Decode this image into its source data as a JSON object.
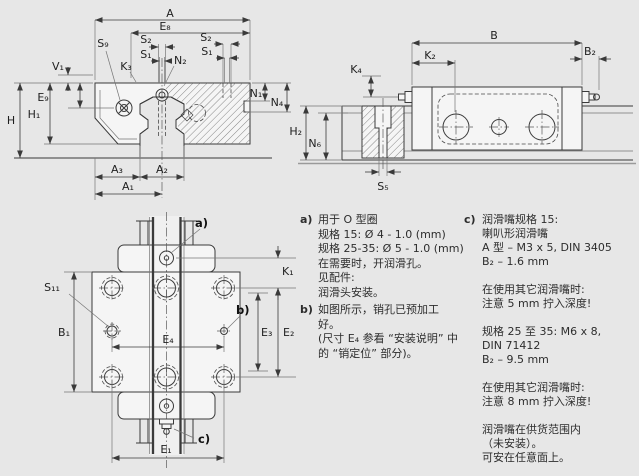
{
  "colors": {
    "background": "#e7e7e7",
    "ink": "#3a3a3a",
    "shape_fill": "#f5f5f5",
    "gray_line": "#9a9a9a"
  },
  "views": {
    "front": {
      "dims": {
        "A": "A",
        "E8": "E₈",
        "S2": "S₂",
        "S1": "S₁",
        "N2": "N₂",
        "S9": "S₉",
        "K3": "K₃",
        "V1": "V₁",
        "E9": "E₉",
        "H": "H",
        "H1": "H₁",
        "N1": "N₁",
        "N4": "N₄",
        "A3": "A₃",
        "A2": "A₂",
        "A1": "A₁"
      }
    },
    "side": {
      "dims": {
        "B": "B",
        "K2": "K₂",
        "B2": "B₂",
        "K4": "K₄",
        "H2": "H₂",
        "N6": "N₆",
        "S5": "S₅"
      }
    },
    "plan": {
      "dims": {
        "K1": "K₁",
        "S11": "S₁₁",
        "B1": "B₁",
        "E3": "E₃",
        "E2": "E₂",
        "E4": "E₄",
        "E1": "E₁"
      },
      "callouts": {
        "a": "a)",
        "b": "b)",
        "c": "c)"
      }
    }
  },
  "notes": {
    "a": {
      "tag": "a)",
      "text": "用于 O 型圈\n规格 15: Ø 4 - 1.0 (mm)\n规格 25-35: Ø 5 - 1.0 (mm)\n在需要时，开润滑孔。\n见配件:\n润滑头安装。"
    },
    "b": {
      "tag": "b)",
      "text": "如图所示，销孔已预加工\n好。\n(尺寸 E₄ 参看 “安装说明” 中\n的 “销定位” 部分)。"
    },
    "c": {
      "tag": "c)",
      "text": "润滑嘴规格 15:\n喇叭形润滑嘴\nA 型 – M3 x 5, DIN 3405\nB₂ – 1.6 mm\n\n在使用其它润滑嘴时:\n注意 5 mm 拧入深度!\n\n规格 25 至 35: M6 x 8,\nDIN 71412\nB₂ – 9.5 mm\n\n在使用其它润滑嘴时:\n注意 8 mm 拧入深度!\n\n润滑嘴在供货范围内\n（未安装）。\n可安在任意面上。"
    }
  }
}
